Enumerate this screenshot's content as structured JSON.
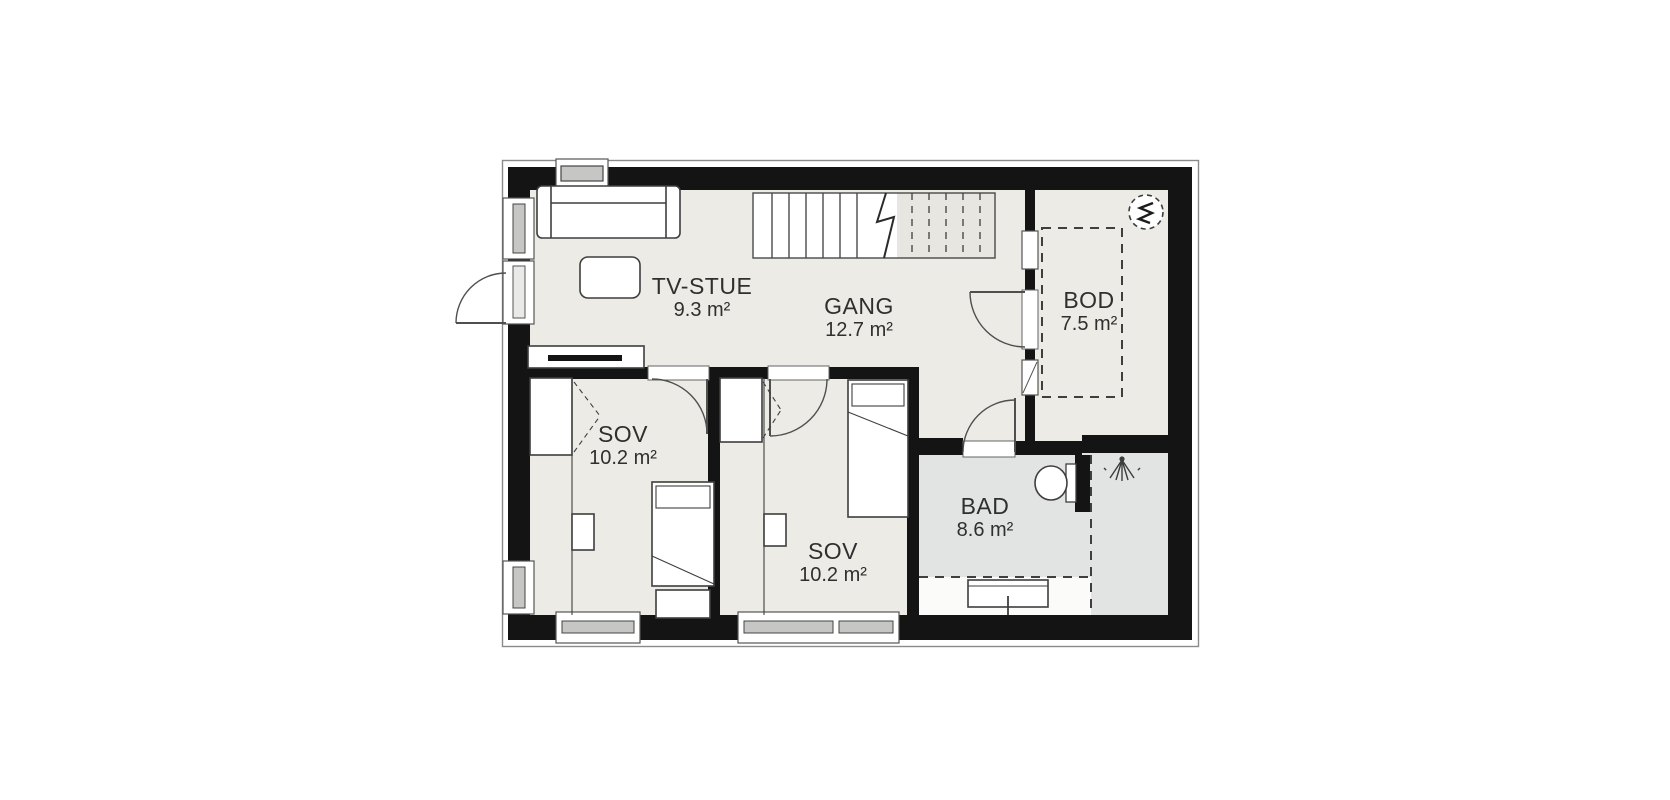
{
  "floorplan": {
    "type": "residential-floorplan",
    "rooms": [
      {
        "name": "TV-STUE",
        "area": "9.3 m²",
        "area_m2": 9.3
      },
      {
        "name": "GANG",
        "area": "12.7 m²",
        "area_m2": 12.7
      },
      {
        "name": "BOD",
        "area": "7.5 m²",
        "area_m2": 7.5
      },
      {
        "name": "SOV",
        "area": "10.2 m²",
        "area_m2": 10.2
      },
      {
        "name": "SOV",
        "area": "10.2 m²",
        "area_m2": 10.2
      },
      {
        "name": "BAD",
        "area": "8.6 m²",
        "area_m2": 8.6
      }
    ],
    "symbols": [
      {
        "icon": "stairs",
        "location": "GANG"
      },
      {
        "icon": "water-heater-icon",
        "location": "BOD"
      },
      {
        "icon": "shower-icon",
        "location": "BAD"
      },
      {
        "icon": "toilet",
        "location": "BAD"
      }
    ],
    "colors": {
      "wall": "#141414",
      "floor": "#ecebe5",
      "floor_bath": "#e2e3e3",
      "stair_upper": "#e7e6e0",
      "line": "#454545",
      "glazing": "#c6c6c4",
      "background": "#ffffff"
    }
  }
}
